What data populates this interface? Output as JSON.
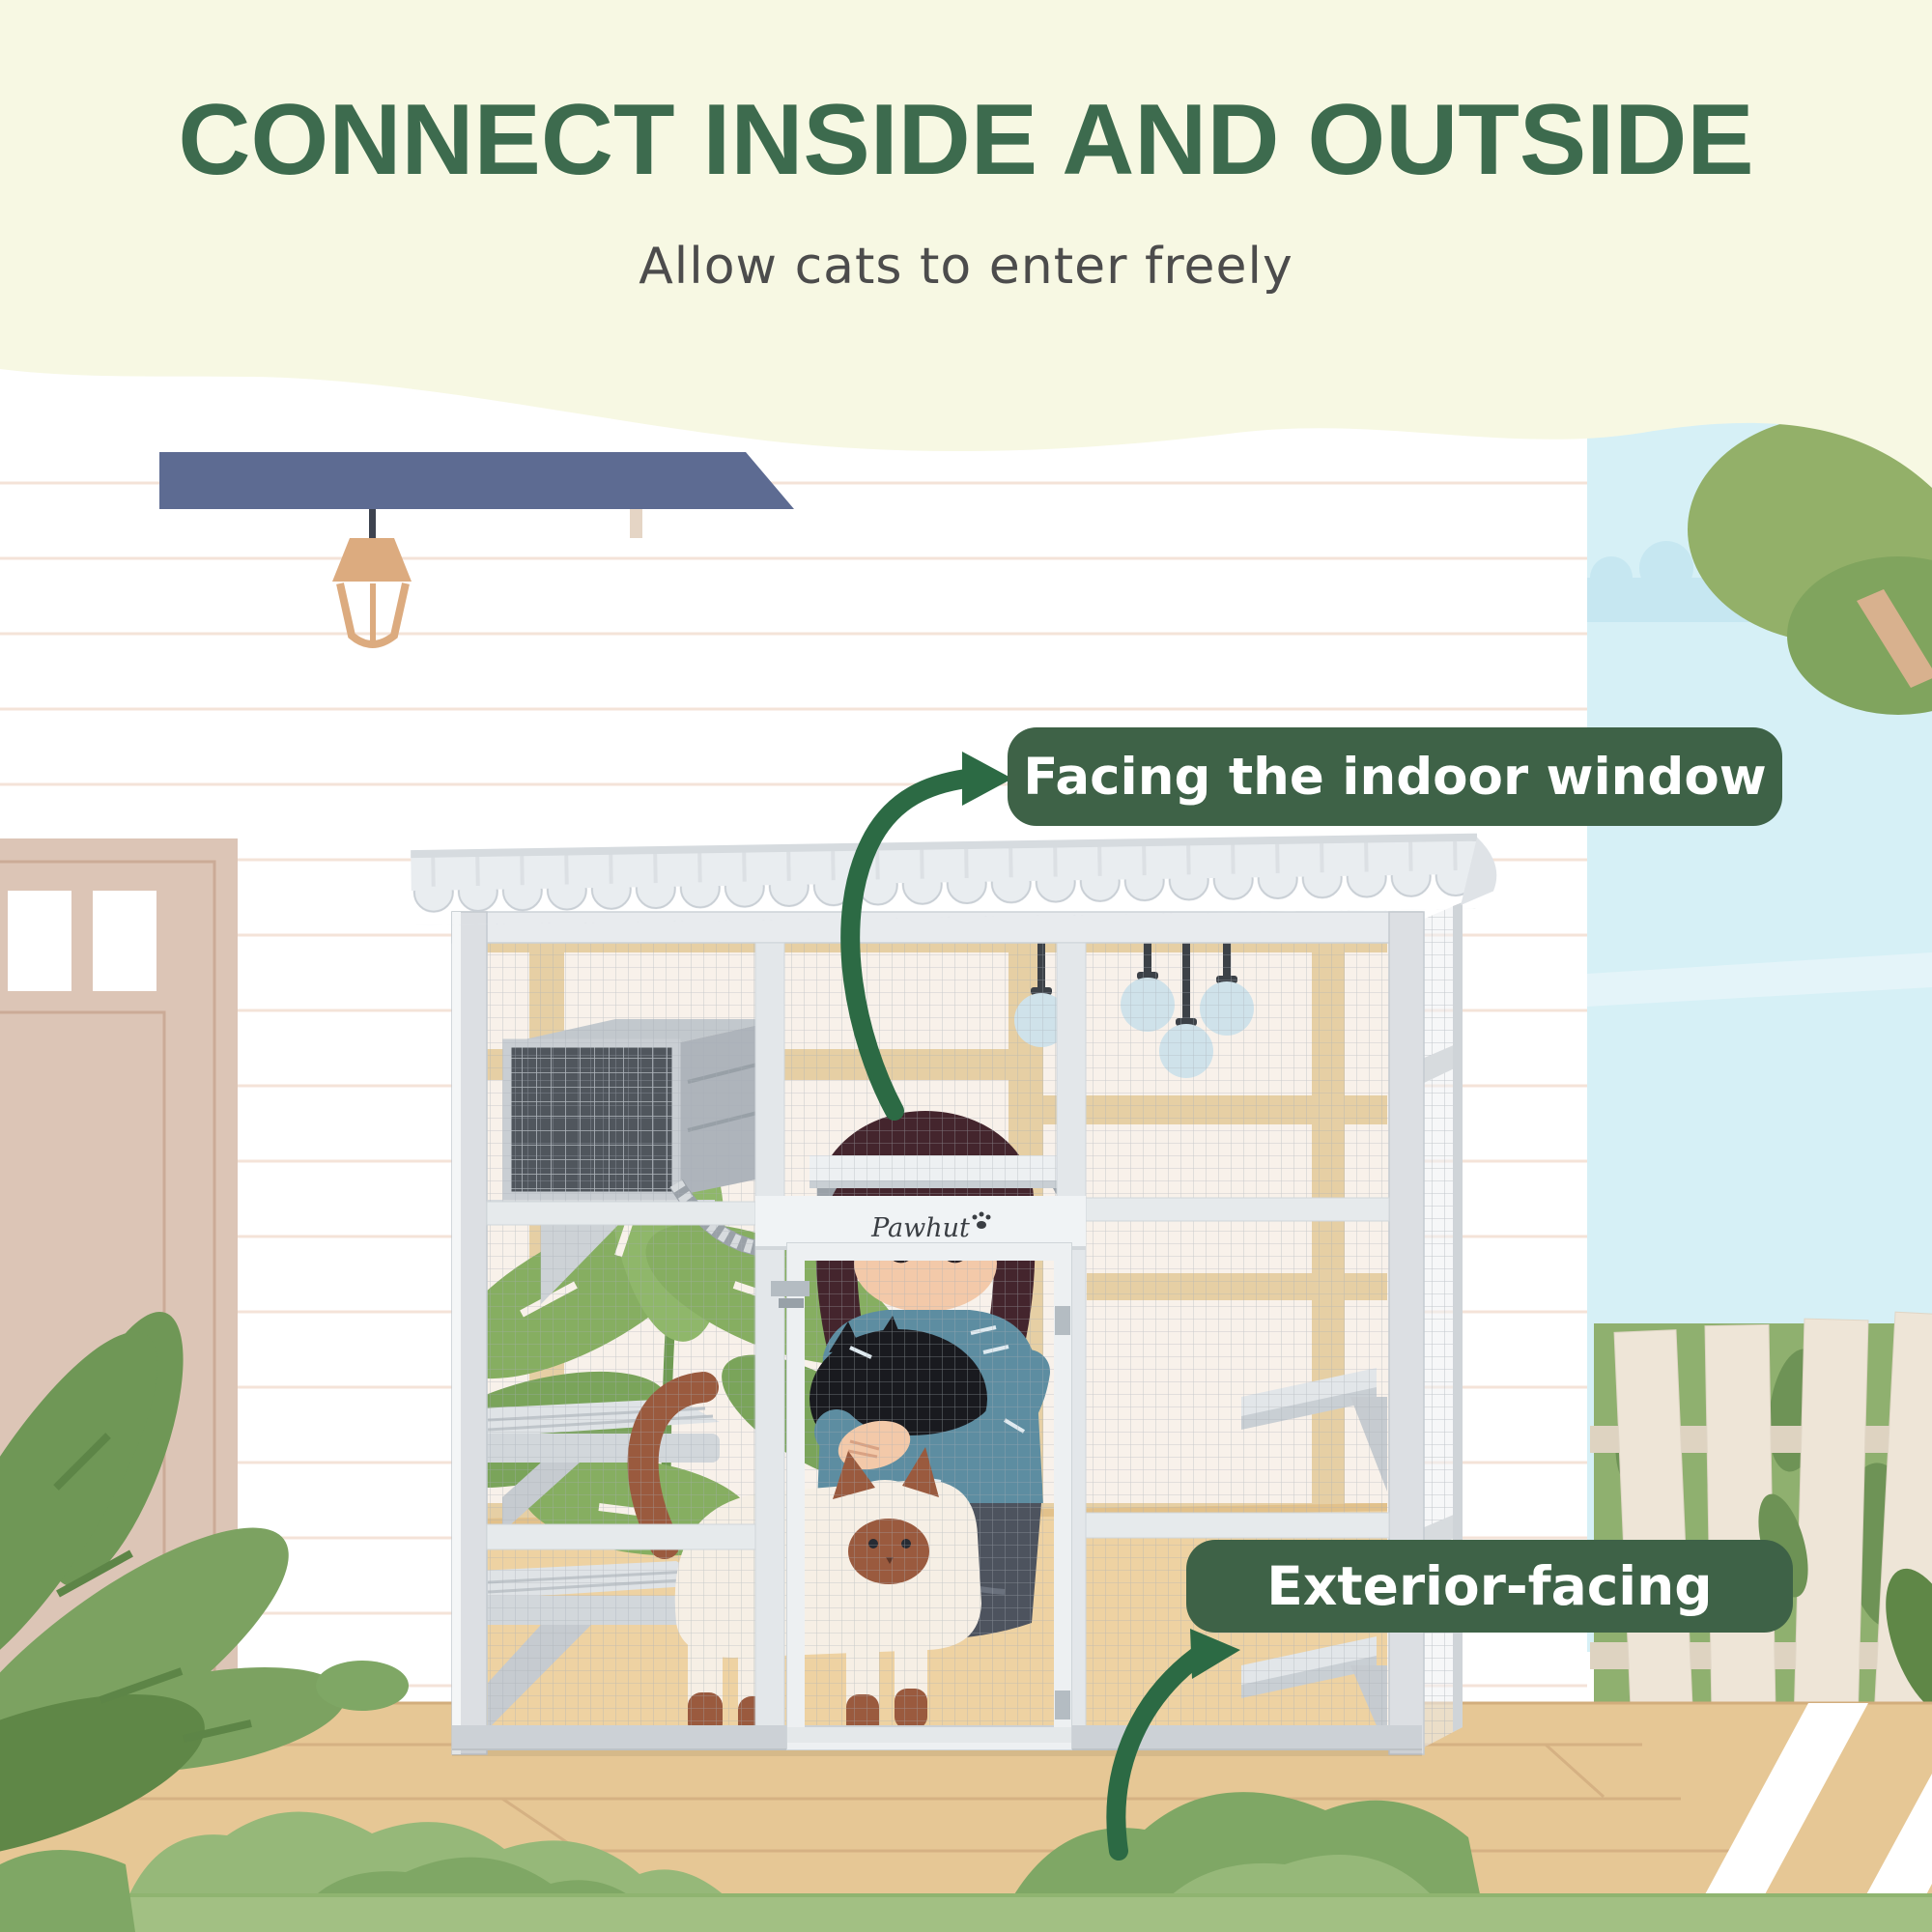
{
  "header": {
    "title": "CONNECT INSIDE AND OUTSIDE",
    "subtitle": "Allow cats to enter freely"
  },
  "callouts": [
    {
      "id": "indoor-window",
      "label": "Facing the indoor window"
    },
    {
      "id": "exterior",
      "label": "Exterior-facing"
    }
  ],
  "brand": {
    "logo_text": "Pawhut"
  },
  "icons": {
    "logo_paw": "paw-icon"
  },
  "colors": {
    "title_green": "#3d6b4e",
    "subtitle_gray": "#4c4c4c",
    "badge_green": "#3e6247",
    "badge_text": "#ffffff",
    "arrow_green": "#2c6a44",
    "top_band_cream": "#f7f8e3",
    "sky_blue": "#d6f0f6",
    "awning_blue": "#5d6b92",
    "door_beige": "#dcc5b6",
    "deck_tan": "#e6c795",
    "fence_cream": "#eee5d7",
    "foliage_green": "#8fb06f",
    "frame_gray": "#dcdfe3",
    "mesh_gray": "#a7aeb6",
    "floor_tan": "#eed2a2",
    "cat_point_brown": "#9a5a3e",
    "siding_line": "#f4e3d8"
  }
}
